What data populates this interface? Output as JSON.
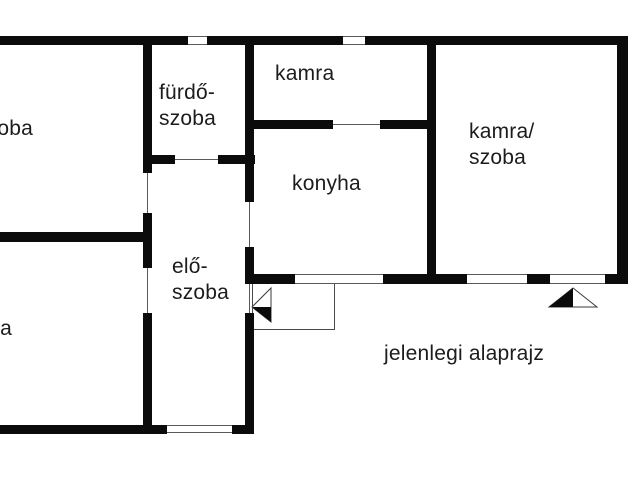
{
  "caption": {
    "text": "jelenlegi alaprajz"
  },
  "colors": {
    "wall": "#0b0b0b",
    "thin_line": "#5a5a5a",
    "background": "#ffffff",
    "text": "#1c1c1c"
  },
  "floorplan": {
    "rooms": [
      {
        "id": "szoba-top-left",
        "text": "szoba",
        "x": -24,
        "y": 116
      },
      {
        "id": "furdo-szoba",
        "text": "fürdő-\nszoba",
        "x": 159,
        "y": 80
      },
      {
        "id": "kamra",
        "text": "kamra",
        "x": 275,
        "y": 61
      },
      {
        "id": "konyha",
        "text": "konyha",
        "x": 292,
        "y": 171
      },
      {
        "id": "kamra-szoba",
        "text": "kamra/\nszoba",
        "x": 469,
        "y": 119
      },
      {
        "id": "elo-szoba",
        "text": "elő-\nszoba",
        "x": 172,
        "y": 254
      },
      {
        "id": "szoba-bottom-left",
        "text": "szoba",
        "x": -45,
        "y": 316
      }
    ],
    "walls": [
      [
        0,
        36,
        188,
        9
      ],
      [
        207,
        36,
        136,
        9
      ],
      [
        365,
        36,
        263,
        9
      ],
      [
        143,
        36,
        9,
        137
      ],
      [
        143,
        213,
        9,
        55
      ],
      [
        143,
        313,
        9,
        121
      ],
      [
        245,
        36,
        9,
        166
      ],
      [
        245,
        247,
        9,
        37
      ],
      [
        245,
        313,
        9,
        121
      ],
      [
        143,
        155,
        32,
        9
      ],
      [
        218,
        155,
        37,
        9
      ],
      [
        245,
        120,
        88,
        9
      ],
      [
        380,
        120,
        56,
        9
      ],
      [
        427,
        36,
        9,
        248
      ],
      [
        617,
        36,
        11,
        248
      ],
      [
        245,
        274,
        50,
        10
      ],
      [
        383,
        274,
        84,
        10
      ],
      [
        527,
        274,
        23,
        10
      ],
      [
        605,
        274,
        23,
        10
      ],
      [
        0,
        232,
        152,
        10
      ],
      [
        0,
        425,
        167,
        9
      ],
      [
        232,
        425,
        22,
        9
      ]
    ],
    "thin_lines": [
      [
        188,
        36,
        19,
        1
      ],
      [
        188,
        44,
        19,
        1
      ],
      [
        343,
        36,
        22,
        1
      ],
      [
        343,
        44,
        22,
        1
      ],
      [
        147,
        173,
        1,
        40
      ],
      [
        147,
        268,
        1,
        45
      ],
      [
        249,
        202,
        1,
        45
      ],
      [
        249,
        284,
        1,
        29
      ],
      [
        175,
        159,
        43,
        1
      ],
      [
        333,
        124,
        47,
        1
      ],
      [
        295,
        274,
        88,
        1
      ],
      [
        295,
        283,
        88,
        1
      ],
      [
        467,
        274,
        60,
        1
      ],
      [
        467,
        283,
        60,
        1
      ],
      [
        550,
        274,
        55,
        1
      ],
      [
        550,
        283,
        55,
        1
      ],
      [
        167,
        425,
        65,
        1
      ],
      [
        167,
        432,
        65,
        1
      ]
    ],
    "porch": {
      "x": 252,
      "y": 283,
      "w": 83,
      "h": 47
    },
    "arrows": [
      {
        "name": "entrance-arrow-west",
        "outline": "271,288 252,307 271,322",
        "solid": "252,307 271,307 271,322"
      },
      {
        "name": "entrance-arrow-south",
        "outline": "573,288 549,307 597,307",
        "solid": "573,288 549,307 573,307"
      }
    ]
  }
}
